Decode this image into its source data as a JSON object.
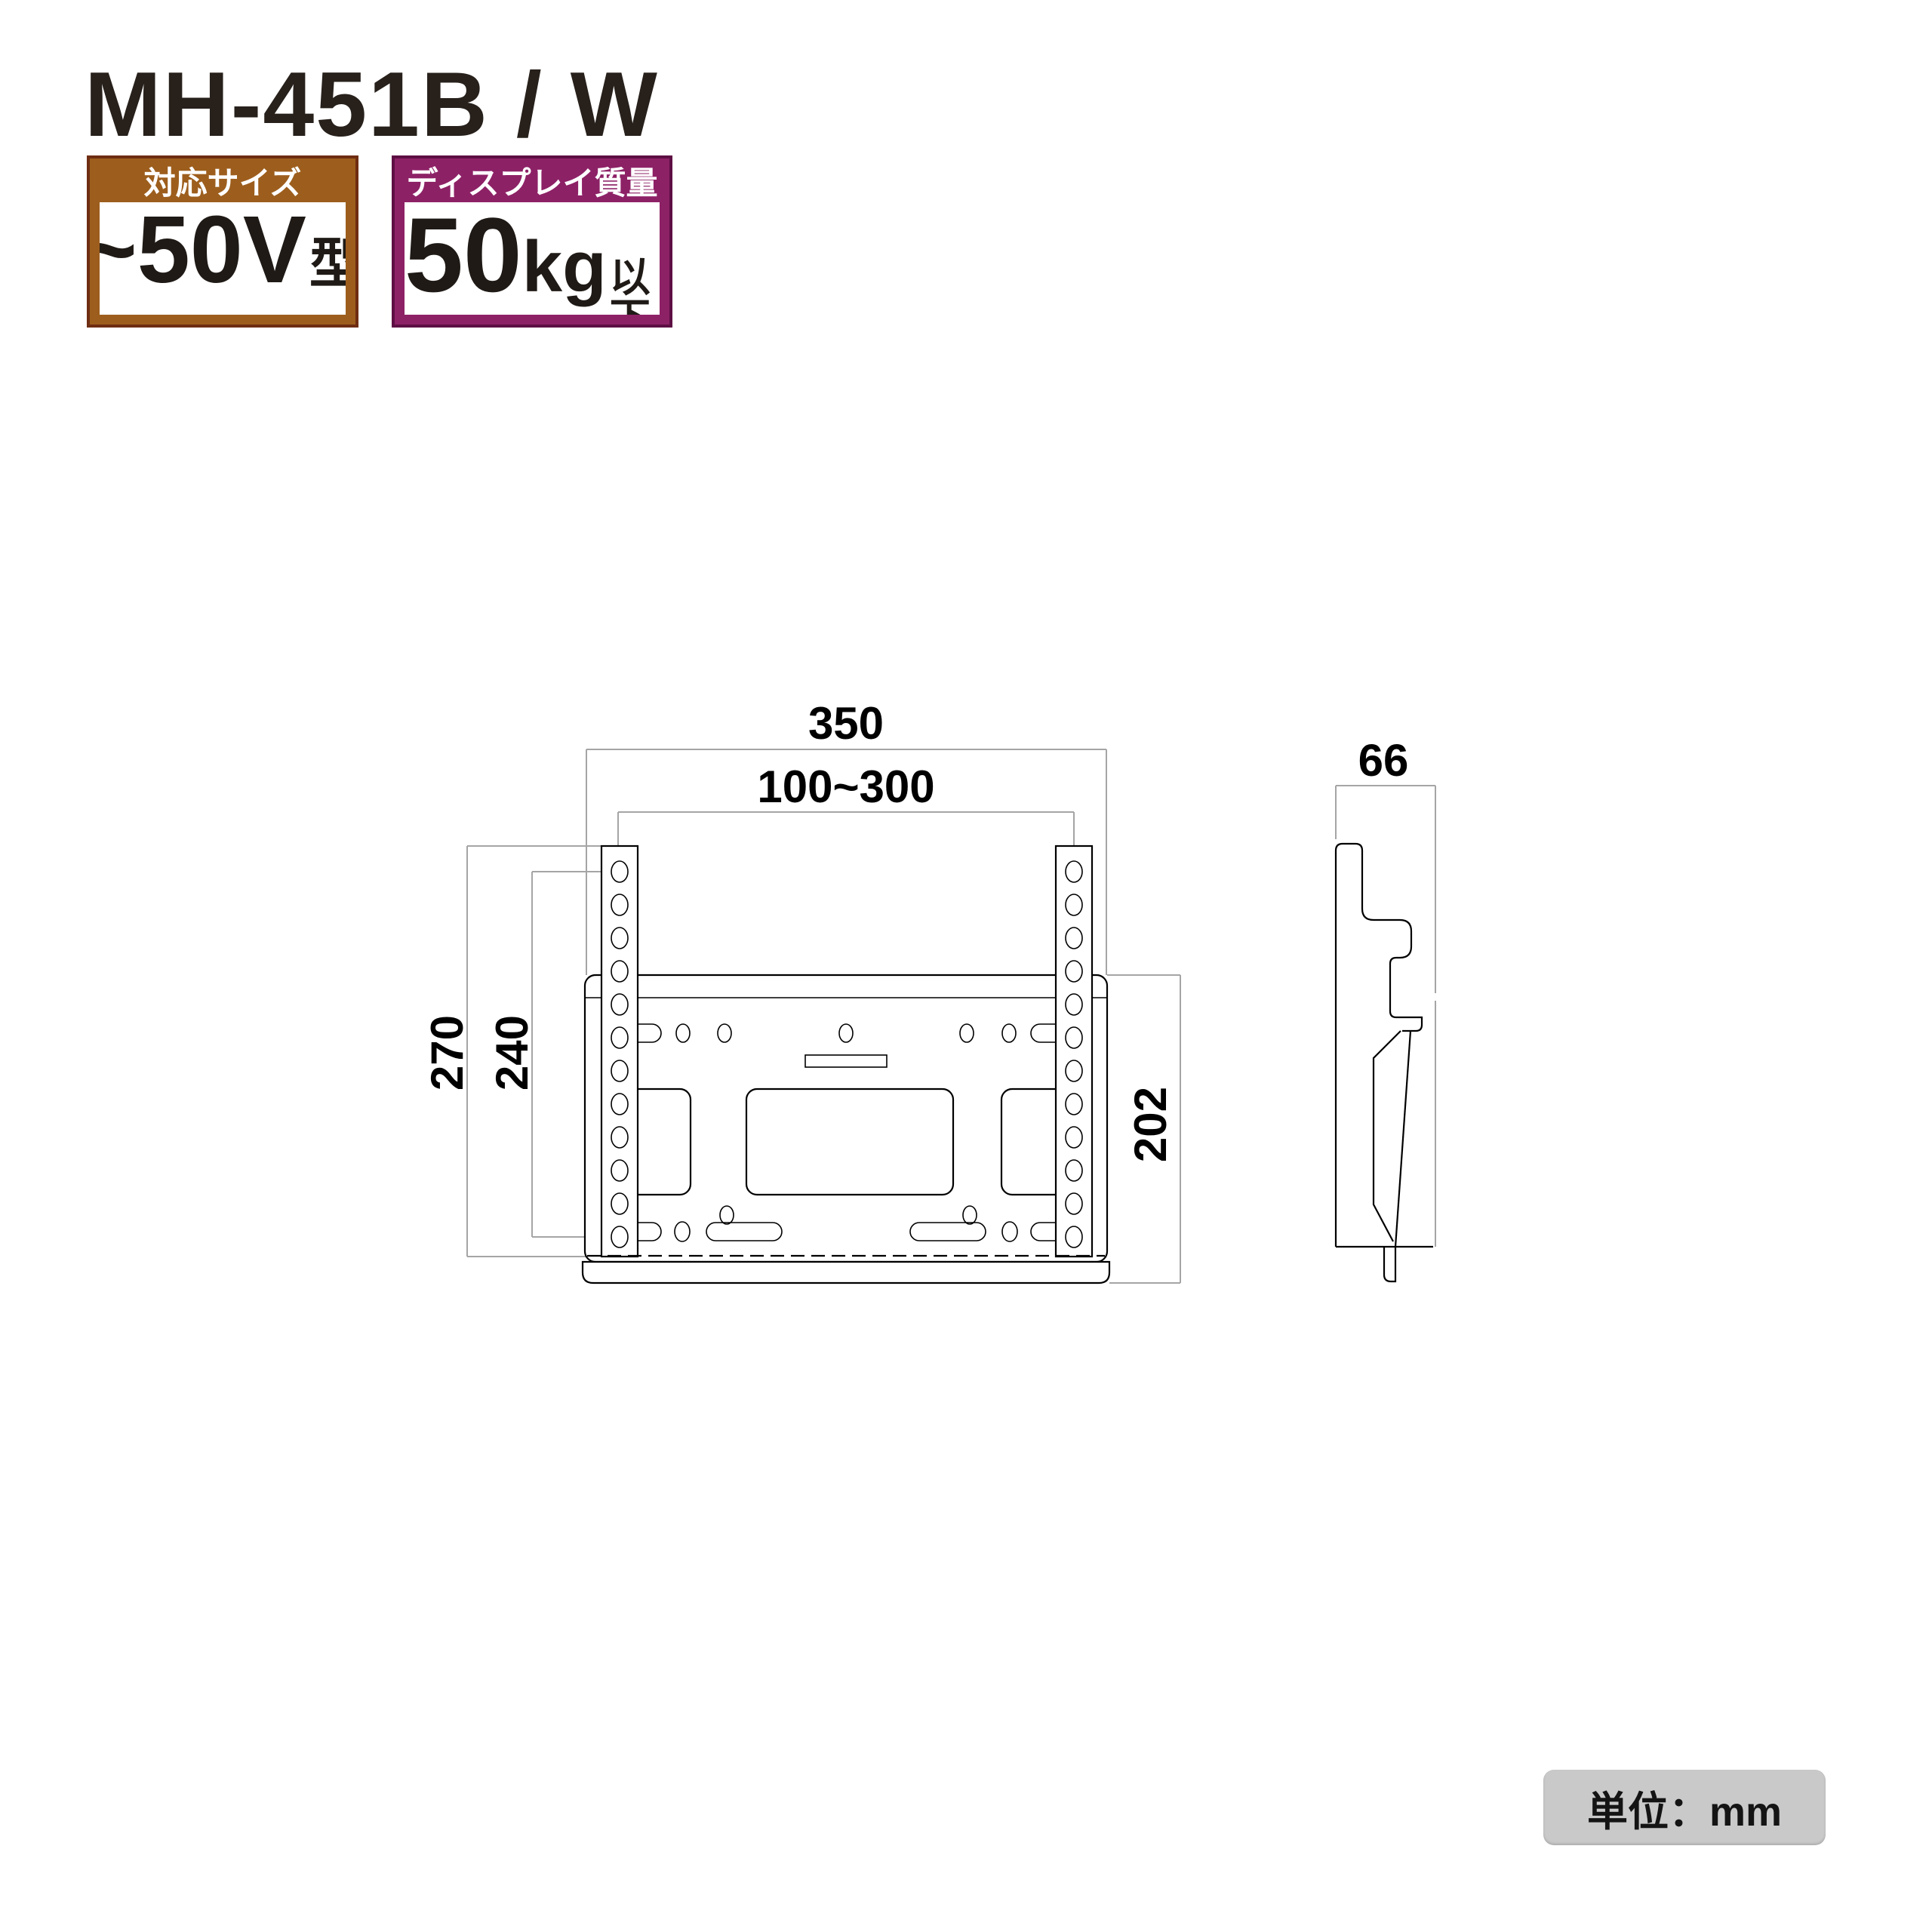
{
  "product": {
    "title": "MH-451B / W"
  },
  "badges": {
    "size": {
      "header": "対応サイズ",
      "value": "~50V",
      "suffix": "型"
    },
    "weight": {
      "header": "ディスプレイ質量",
      "value": "50",
      "unit": "kg",
      "suffix": "以下"
    }
  },
  "dimensions": {
    "front_width": "350",
    "slide_range": "100~300",
    "bracket_height": "270",
    "hole_pitch": "240",
    "plate_height": "202",
    "side_depth": "66"
  },
  "note": {
    "unit_label": "単位：mm"
  },
  "colors": {
    "size_badge_fill": "#9d5e1d",
    "size_badge_border": "#6f2d12",
    "weight_badge_fill": "#8d2166",
    "weight_badge_border": "#5e0f44",
    "drawing_line": "#000000",
    "dimension_line": "#a5a5a5",
    "note_background": "#c9c9c9"
  }
}
